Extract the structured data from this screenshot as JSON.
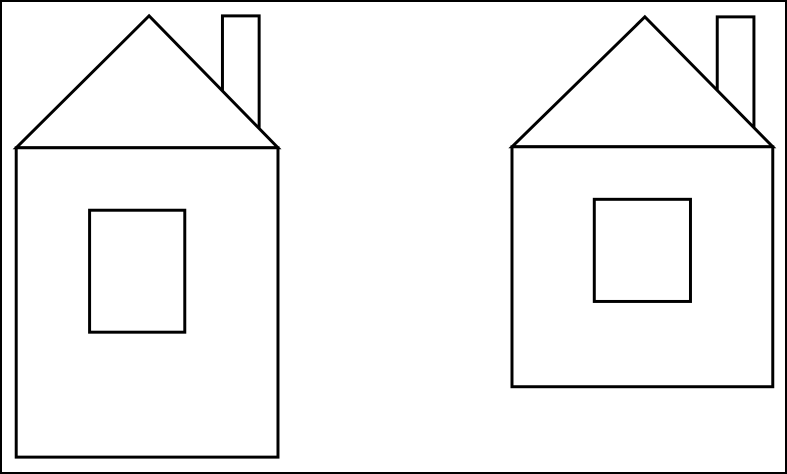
{
  "scene": {
    "description": "Line drawing of two simple houses, each with a rectangular body, triangular roof, chimney behind the right roof slope, and a rectangular window",
    "background_color": "#ffffff",
    "line_color": "#000000",
    "line_width": 3,
    "frame": {
      "color": "#000000",
      "width": 2
    },
    "canvas": {
      "width": 787,
      "height": 474
    },
    "houses": [
      {
        "id": "left-house",
        "body": {
          "x": 13,
          "y": 147,
          "w": 264,
          "h": 312
        },
        "roof": {
          "left": [
            13,
            147
          ],
          "apex": [
            147,
            14
          ],
          "right": [
            277,
            147
          ]
        },
        "chimney": {
          "x": 221,
          "y": 14,
          "w": 37,
          "h": 125
        },
        "window": {
          "x": 87,
          "y": 210,
          "w": 96,
          "h": 123
        }
      },
      {
        "id": "right-house",
        "body": {
          "x": 513,
          "y": 146,
          "w": 263,
          "h": 242
        },
        "roof": {
          "left": [
            513,
            146
          ],
          "apex": [
            647,
            15
          ],
          "right": [
            776,
            146
          ]
        },
        "chimney": {
          "x": 720,
          "y": 15,
          "w": 37,
          "h": 120
        },
        "window": {
          "x": 596,
          "y": 199,
          "w": 97,
          "h": 103
        }
      }
    ]
  }
}
